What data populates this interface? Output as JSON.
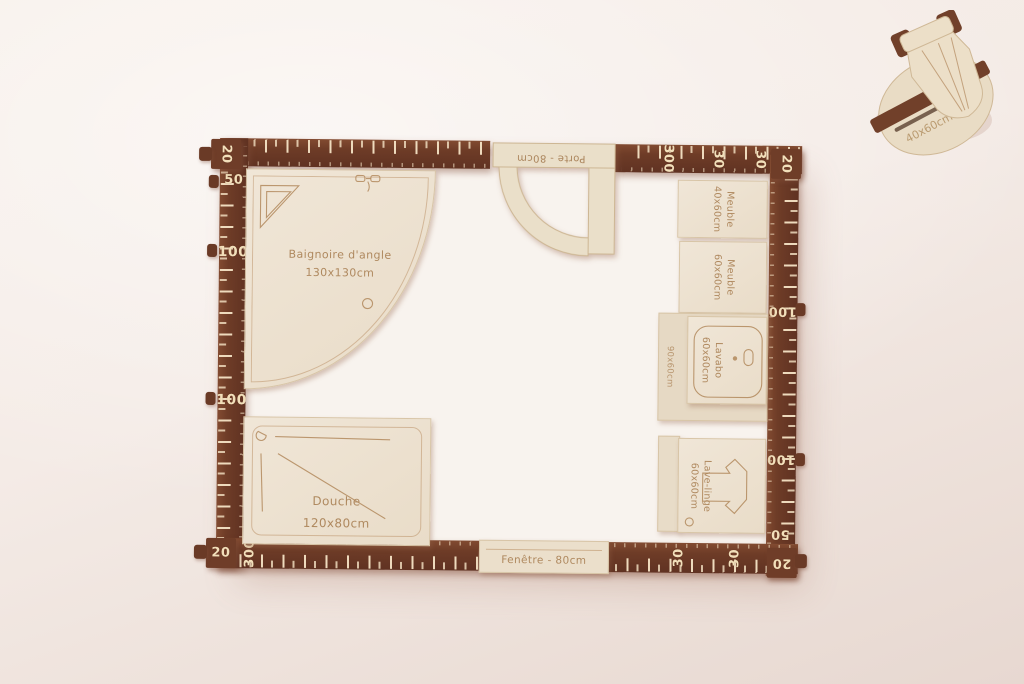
{
  "scene": "wooden bathroom floor-plan model photograph",
  "colors": {
    "background": "#f4ebe6",
    "wood_dark": "#6e3c27",
    "wood_light": "#ece1cf",
    "engraving": "#b98e63",
    "tick_cream": "#f2dfba"
  },
  "rulers": {
    "top": [
      "20",
      "300",
      "30",
      "30",
      "20"
    ],
    "left": [
      "20",
      "50",
      "100",
      "100",
      "20"
    ],
    "right": [
      "20",
      "100",
      "100",
      "50",
      "20"
    ],
    "bottom": [
      "20",
      "300",
      "30",
      "30",
      "20"
    ]
  },
  "pieces": {
    "bathtub": {
      "line1": "Baignoire d'angle",
      "line2": "130x130cm"
    },
    "door": {
      "label": "Porte - 80cm"
    },
    "cabinet_40": {
      "line1": "Meuble",
      "line2": "40x60cm"
    },
    "cabinet_60": {
      "line1": "Meuble",
      "line2": "60x60cm"
    },
    "sink": {
      "line1": "Lavabo",
      "line2": "60x60cm"
    },
    "counter": {
      "label": "90x60cm"
    },
    "washer": {
      "line1": "Lave-linge",
      "line2": "60x60cm"
    },
    "shower": {
      "line1": "Douche",
      "line2": "120x80cm"
    },
    "window": {
      "label": "Fenêtre - 80cm"
    },
    "wc_stack": {
      "label": "40x60cm"
    }
  }
}
